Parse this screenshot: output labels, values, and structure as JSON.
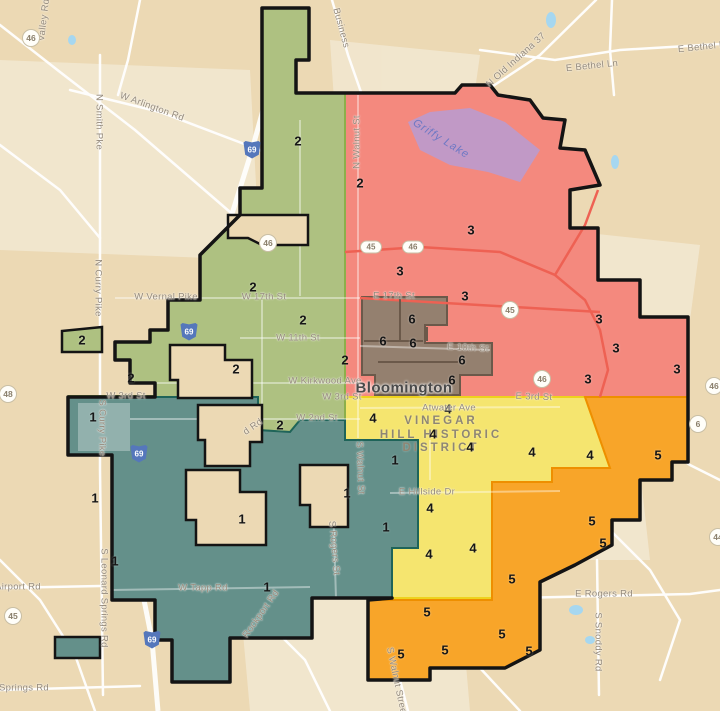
{
  "map": {
    "city_label": "Bloomington",
    "poi_label": {
      "lines": [
        "VINEGAR",
        "HILL HISTORIC",
        "DISTRICT"
      ]
    },
    "water_label": {
      "text": "Griffy Lake",
      "x": 441,
      "y": 139,
      "rot": 32
    },
    "colors": {
      "background": "#ecd9b4",
      "urban_patch": "#f3e9d3",
      "road": "#ffffff",
      "water": "#a6d7f0",
      "lake_overlay": "#b49ed8",
      "city_boundary": "#141414"
    },
    "districts": [
      {
        "number": "1",
        "fill": "#64908a",
        "border": "#1f6459",
        "labels": [
          [
            93,
            417
          ],
          [
            95,
            498
          ],
          [
            115,
            561
          ],
          [
            242,
            519
          ],
          [
            267,
            587
          ],
          [
            347,
            493
          ],
          [
            386,
            527
          ],
          [
            395,
            460
          ]
        ]
      },
      {
        "number": "2",
        "fill": "#aec181",
        "border": "#8caf4b",
        "labels": [
          [
            298,
            141
          ],
          [
            360,
            183
          ],
          [
            253,
            287
          ],
          [
            303,
            320
          ],
          [
            345,
            360
          ],
          [
            236,
            369
          ],
          [
            82,
            340
          ],
          [
            131,
            378
          ],
          [
            280,
            425
          ]
        ]
      },
      {
        "number": "3",
        "fill": "#f4897e",
        "border": "#e8463c",
        "labels": [
          [
            471,
            230
          ],
          [
            400,
            271
          ],
          [
            465,
            296
          ],
          [
            599,
            319
          ],
          [
            616,
            348
          ],
          [
            588,
            379
          ],
          [
            677,
            369
          ]
        ]
      },
      {
        "number": "4",
        "fill": "#f5e56f",
        "border": "#eed21d",
        "labels": [
          [
            373,
            418
          ],
          [
            448,
            409
          ],
          [
            433,
            434
          ],
          [
            470,
            447
          ],
          [
            532,
            452
          ],
          [
            590,
            455
          ],
          [
            430,
            508
          ],
          [
            473,
            548
          ],
          [
            429,
            554
          ]
        ]
      },
      {
        "number": "5",
        "fill": "#f8a529",
        "border": "#ee8f00",
        "labels": [
          [
            658,
            455
          ],
          [
            592,
            521
          ],
          [
            603,
            543
          ],
          [
            512,
            579
          ],
          [
            427,
            612
          ],
          [
            502,
            634
          ],
          [
            445,
            650
          ],
          [
            529,
            651
          ],
          [
            401,
            654
          ]
        ]
      },
      {
        "number": "6",
        "fill": "#94806f",
        "border": "#6b594a",
        "labels": [
          [
            412,
            319
          ],
          [
            383,
            341
          ],
          [
            413,
            343
          ],
          [
            462,
            360
          ],
          [
            452,
            380
          ]
        ]
      }
    ],
    "street_labels": [
      {
        "text": "Valley Rd",
        "x": 44,
        "y": 20,
        "rot": -83
      },
      {
        "text": "N Smith Pke",
        "x": 99,
        "y": 122,
        "rot": 90
      },
      {
        "text": "W Arlington Rd",
        "x": 152,
        "y": 107,
        "rot": 20
      },
      {
        "text": "N Curry Pike",
        "x": 98,
        "y": 288,
        "rot": 90
      },
      {
        "text": "S Curry Pike",
        "x": 102,
        "y": 428,
        "rot": 90
      },
      {
        "text": "S Leonard Springs Rd",
        "x": 104,
        "y": 598,
        "rot": 90
      },
      {
        "text": "Airport Rd",
        "x": 18,
        "y": 587,
        "rot": 0
      },
      {
        "text": "Springs Rd",
        "x": 24,
        "y": 688,
        "rot": 0
      },
      {
        "text": "Business",
        "x": 341,
        "y": 28,
        "rot": 75
      },
      {
        "text": "N Old Indiana 37",
        "x": 516,
        "y": 60,
        "rot": -42
      },
      {
        "text": "E Bethel Ln",
        "x": 592,
        "y": 66,
        "rot": -6
      },
      {
        "text": "E Bethel Ln",
        "x": 704,
        "y": 47,
        "rot": -6
      },
      {
        "text": "N Walnut St",
        "x": 357,
        "y": 142,
        "rot": -90
      },
      {
        "text": "W Vernal Pike",
        "x": 166,
        "y": 297,
        "rot": 0
      },
      {
        "text": "W 17th St",
        "x": 264,
        "y": 297,
        "rot": 0
      },
      {
        "text": "E 17th St",
        "x": 394,
        "y": 296,
        "rot": 0
      },
      {
        "text": "W 11th St",
        "x": 298,
        "y": 338,
        "rot": 0
      },
      {
        "text": "W Kirkwood Ave",
        "x": 325,
        "y": 381,
        "rot": 0
      },
      {
        "text": "W 3rd St",
        "x": 126,
        "y": 396,
        "rot": 0
      },
      {
        "text": "W 3rd St",
        "x": 342,
        "y": 397,
        "rot": 0
      },
      {
        "text": "W 2nd St",
        "x": 317,
        "y": 418,
        "rot": 0
      },
      {
        "text": "E 10th St",
        "x": 468,
        "y": 348,
        "rot": 3
      },
      {
        "text": "E 3rd St",
        "x": 534,
        "y": 397,
        "rot": 2
      },
      {
        "text": "Atwater Ave",
        "x": 449,
        "y": 408,
        "rot": 0
      },
      {
        "text": "E Hillside Dr",
        "x": 427,
        "y": 492,
        "rot": 0
      },
      {
        "text": "W Tapp Rd",
        "x": 203,
        "y": 588,
        "rot": 0
      },
      {
        "text": "E Rogers Rd",
        "x": 604,
        "y": 594,
        "rot": 0
      },
      {
        "text": "S Snoddy Rd",
        "x": 598,
        "y": 642,
        "rot": 90
      },
      {
        "text": "S Rogers St",
        "x": 334,
        "y": 548,
        "rot": 85
      },
      {
        "text": "S Walnut St",
        "x": 360,
        "y": 468,
        "rot": 88
      },
      {
        "text": "S Walnut Street Pike",
        "x": 399,
        "y": 693,
        "rot": 78
      },
      {
        "text": "Rockport Rd",
        "x": 261,
        "y": 614,
        "rot": -55
      },
      {
        "text": "d Rd",
        "x": 253,
        "y": 427,
        "rot": -35
      }
    ],
    "route_badges": [
      {
        "type": "circle",
        "text": "46",
        "x": 31,
        "y": 38
      },
      {
        "type": "circle",
        "text": "46",
        "x": 268,
        "y": 243
      },
      {
        "type": "oval",
        "text": "45",
        "x": 371,
        "y": 247
      },
      {
        "type": "oval",
        "text": "46",
        "x": 413,
        "y": 247
      },
      {
        "type": "circle",
        "text": "45",
        "x": 510,
        "y": 310
      },
      {
        "type": "circle",
        "text": "46",
        "x": 542,
        "y": 379
      },
      {
        "type": "circle",
        "text": "48",
        "x": 8,
        "y": 394
      },
      {
        "type": "circle",
        "text": "45",
        "x": 13,
        "y": 616
      },
      {
        "type": "circle",
        "text": "46",
        "x": 714,
        "y": 386
      },
      {
        "type": "circle",
        "text": "6",
        "x": 698,
        "y": 424
      },
      {
        "type": "circle",
        "text": "44",
        "x": 718,
        "y": 537
      }
    ],
    "interstate_badges": [
      {
        "text": "69",
        "x": 252,
        "y": 149
      },
      {
        "text": "69",
        "x": 189,
        "y": 331
      },
      {
        "text": "69",
        "x": 139,
        "y": 453
      },
      {
        "text": "69",
        "x": 152,
        "y": 639
      }
    ]
  }
}
